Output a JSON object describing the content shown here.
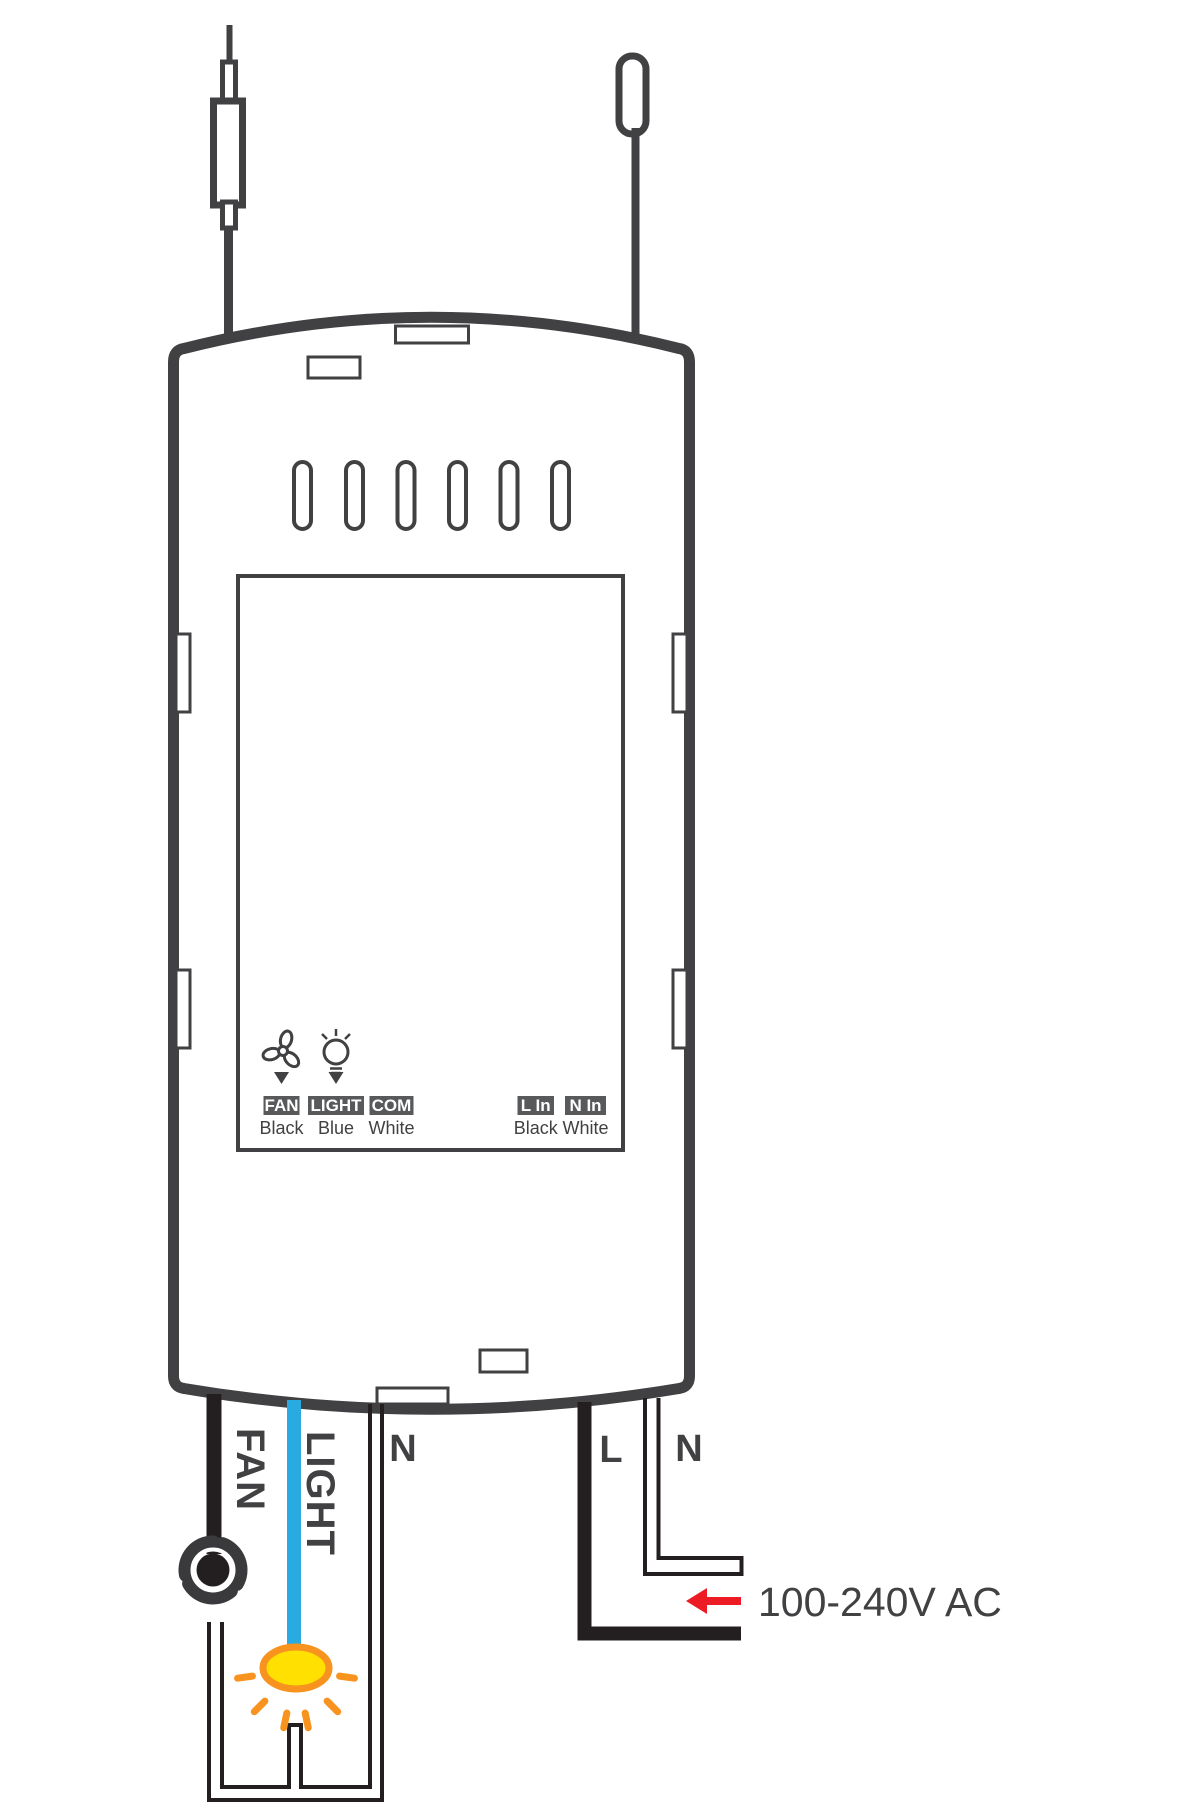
{
  "receiver": {
    "terminals": [
      {
        "badge": "FAN",
        "wire_color": "Black"
      },
      {
        "badge": "LIGHT",
        "wire_color": "Blue"
      },
      {
        "badge": "COM",
        "wire_color": "White"
      },
      {
        "badge": "L In",
        "wire_color": "Black"
      },
      {
        "badge": "N In",
        "wire_color": "White"
      }
    ]
  },
  "output_wires": {
    "fan": "FAN",
    "light": "LIGHT",
    "neutral": "N"
  },
  "input_wires": {
    "live": "L",
    "neutral": "N"
  },
  "power_source": {
    "label": "100-240V AC"
  },
  "colors": {
    "outline": "#414042",
    "wire_black": "#231F20",
    "light_blue": "#29ABE2",
    "live_red": "#ED1C24",
    "glow_orange": "#F7931E",
    "glow_yellow": "#FFE000",
    "badge_bg": "#58595B"
  }
}
